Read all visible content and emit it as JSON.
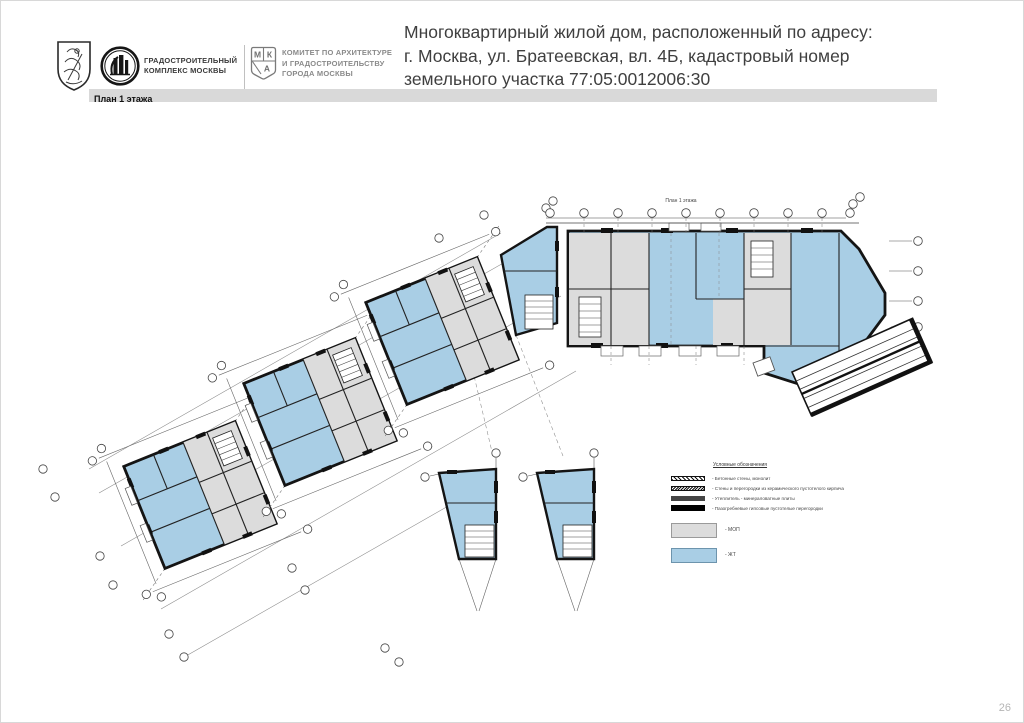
{
  "page": {
    "number": "26"
  },
  "header": {
    "title_lines": [
      "Многоквартирный жилой дом, расположенный по адресу:",
      "г. Москва, ул. Братеевская, вл. 4Б, кадастровый номер",
      "земельного участка 77:05:0012006:30"
    ],
    "section_label": "План 1 этажа",
    "logos": {
      "gradostroy_lines": [
        "ГРАДОСТРОИТЕЛЬНЫЙ",
        "КОМПЛЕКС МОСКВЫ"
      ],
      "mka_letters": {
        "m": "М",
        "k": "К",
        "a": "А"
      },
      "committee_lines": [
        "КОМИТЕТ ПО АРХИТЕКТУРЕ",
        "И ГРАДОСТРОИТЕЛЬСТВУ",
        "ГОРОДА МОСКВЫ"
      ]
    }
  },
  "plan": {
    "mini_title": "План 1 этажа"
  },
  "legend": {
    "title": "Условные обозначения",
    "line_items": [
      "- Бетонные стены, монолит",
      "- Стены и перегородки из керамического пустотелого кирпича",
      "- Утеплитель - минераловатные плиты",
      "- Пазогребневые гипсовые пустотелые перегородки"
    ],
    "area_items": [
      {
        "label": "- МОП",
        "color": "#dcdcdc"
      },
      {
        "label": "- ЖТ",
        "color": "#a9cee5"
      }
    ]
  },
  "colors": {
    "apartment_blue": "#a9cee5",
    "common_gray": "#dcdcdc",
    "wall_black": "#141414",
    "band_gray": "#d9d9d9",
    "title_text": "#3f3f3f"
  }
}
